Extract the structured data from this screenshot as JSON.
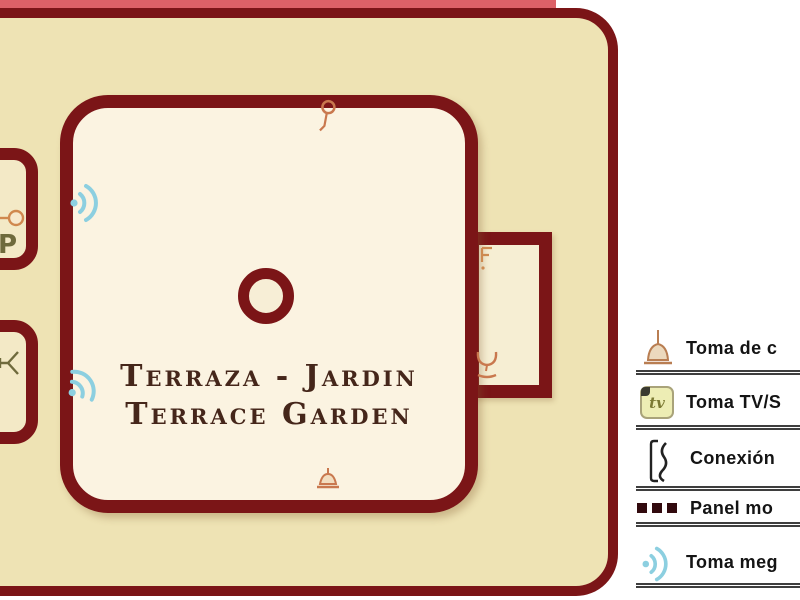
{
  "plan": {
    "title_line1": "Terraza - Jardin",
    "title_line2": "Terrace Garden",
    "room_letter": "P"
  },
  "legend": {
    "tv_icon_label": "tv",
    "rows": [
      {
        "name": "power-outlet",
        "label": "Toma de c"
      },
      {
        "name": "tv-sat-outlet",
        "label": "Toma TV/S"
      },
      {
        "name": "phone-connection",
        "label": "Conexión"
      },
      {
        "name": "movable-panel",
        "label": "Panel mo"
      },
      {
        "name": "speaker-outlet",
        "label": "Toma meg"
      }
    ]
  },
  "colors": {
    "wall": "#7b1517",
    "outer_fill": "#eee3b4",
    "inner_fill": "#fbf3e1",
    "accent_orange": "#c9784e",
    "accent_blue": "#8ccfe0",
    "accent_olive": "#6f6a3c",
    "title_text": "#45261a"
  }
}
